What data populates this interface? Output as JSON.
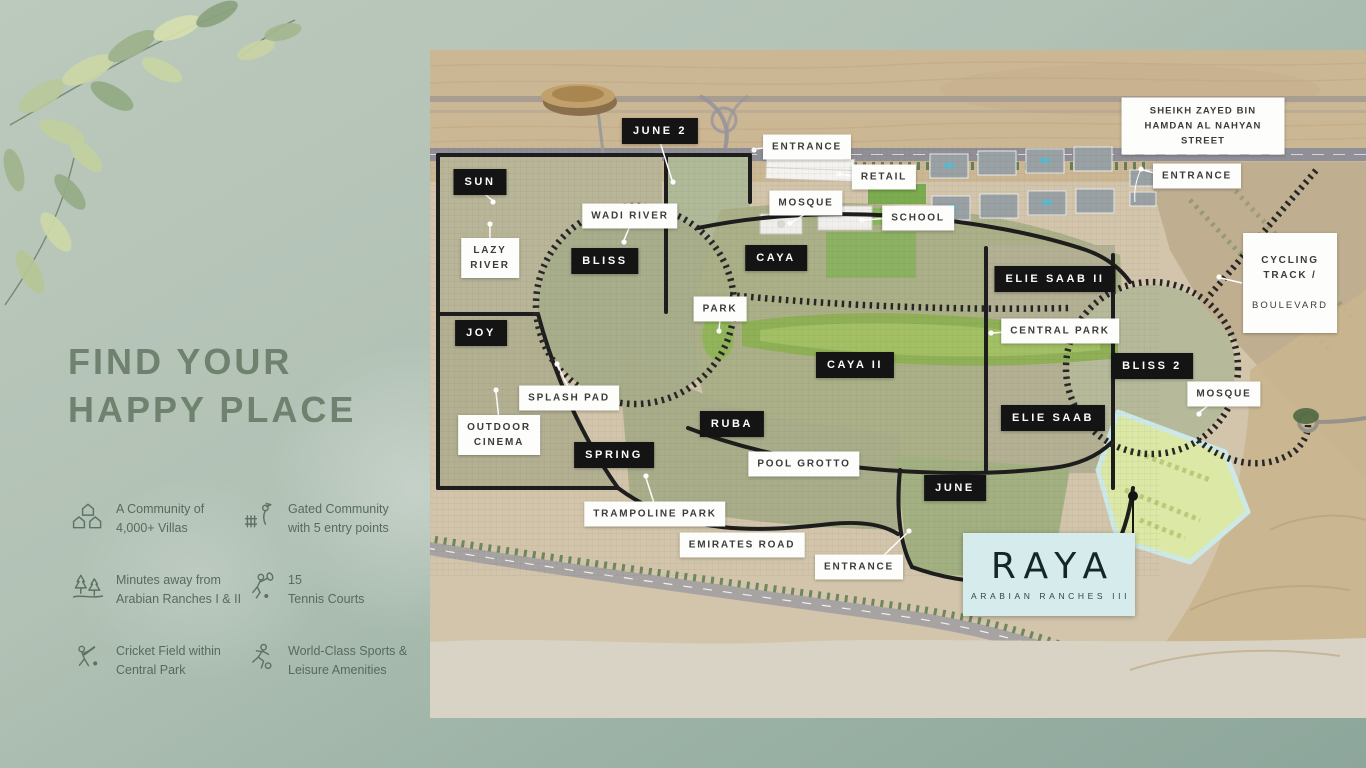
{
  "page": {
    "background_top": "#bcc9bd",
    "background_bottom": "#8da69b"
  },
  "left_panel": {
    "heading_line1": "FIND YOUR",
    "heading_line2": "HAPPY PLACE",
    "heading_color": "#6f816f",
    "features": [
      {
        "icon": "community-villas-icon",
        "text": "A Community of\n4,000+ Villas"
      },
      {
        "icon": "gated-community-icon",
        "text": "Gated Community\nwith 5 entry points"
      },
      {
        "icon": "trees-icon",
        "text": "Minutes away from\nArabian Ranches I & II"
      },
      {
        "icon": "tennis-icon",
        "text": "15\nTennis Courts"
      },
      {
        "icon": "cricket-icon",
        "text": "Cricket Field within\nCentral Park"
      },
      {
        "icon": "sports-icon",
        "text": "World-Class Sports &\nLeisure Amenities"
      }
    ]
  },
  "map": {
    "street_top": "SHEIKH ZAYED BIN HAMDAN AL NAHYAN STREET",
    "street_bottom": "EMIRATES ROAD",
    "entrances": {
      "top_left": "ENTRANCE",
      "top_right": "ENTRANCE",
      "bottom": "ENTRANCE"
    },
    "districts": {
      "june2": "JUNE 2",
      "sun": "SUN",
      "bliss": "BLISS",
      "joy": "JOY",
      "caya": "CAYA",
      "caya_ii": "CAYA II",
      "elie_saab_ii": "ELIE SAAB II",
      "elie_saab": "ELIE SAAB",
      "bliss_2": "BLISS 2",
      "spring": "SPRING",
      "ruba": "RUBA",
      "june": "JUNE"
    },
    "amenities": {
      "wadi_river": "WADI RIVER",
      "lazy_river": "LAZY\nRIVER",
      "splash_pad": "SPLASH PAD",
      "outdoor_cinema": "OUTDOOR\nCINEMA",
      "park": "PARK",
      "central_park": "CENTRAL PARK",
      "pool_grotto": "POOL GROTTO",
      "trampoline_park": "TRAMPOLINE PARK",
      "mosque_top": "MOSQUE",
      "mosque_right": "MOSQUE",
      "retail": "RETAIL",
      "school": "SCHOOL"
    },
    "cycling_line1": "CYCLING TRACK /",
    "cycling_line2": "BOULEVARD",
    "logo": {
      "brand": "RAYA",
      "subtitle": "ARABIAN RANCHES III",
      "box_color": "#d6ebec"
    },
    "colors": {
      "district_label_bg": "#141414",
      "amenity_label_bg": "#fdfdfb",
      "sand": "#d2c5ab",
      "park_green": "#8fb057",
      "raya_highlight": "#dce8a5"
    }
  }
}
